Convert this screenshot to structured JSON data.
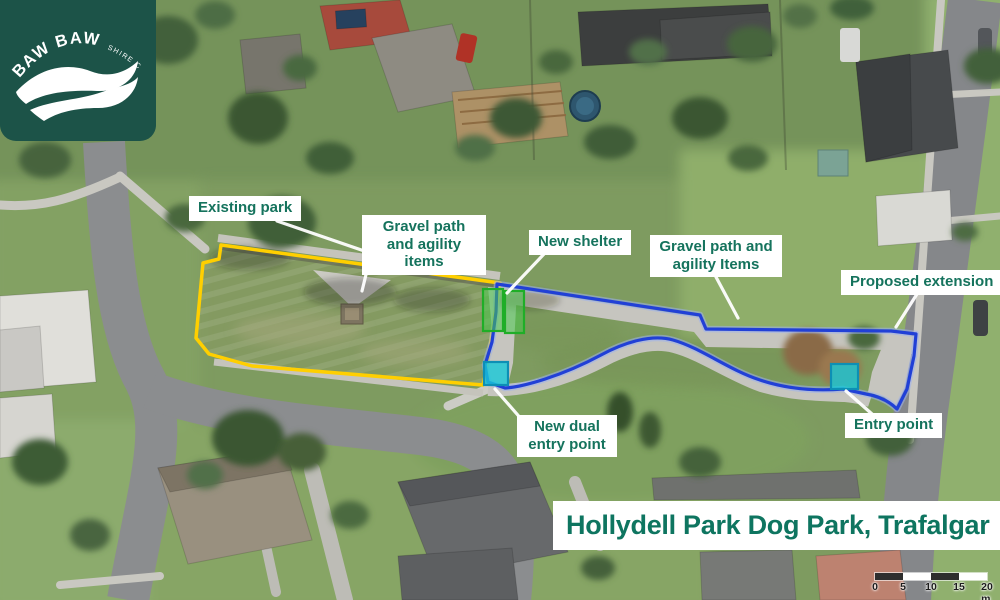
{
  "logo": {
    "org_arc_primary": "BAW BAW",
    "org_arc_secondary": "SHIRE COUNCIL"
  },
  "map": {
    "title": "Hollydell Park Dog Park, Trafalgar",
    "annotations": {
      "existing_park": "Existing park",
      "gravel_path_existing": "Gravel path and agility items",
      "new_shelter": "New shelter",
      "gravel_path_extension": "Gravel path and agility Items",
      "proposed_extension": "Proposed extension",
      "new_dual_entry_point": "New dual entry point",
      "entry_point": "Entry point"
    },
    "colors": {
      "existing_park_outline": "#ffcf00",
      "proposed_extension_outline": "#2140d6",
      "new_shelter_fill": "#49c84d",
      "new_shelter_stroke": "#1fae27",
      "entry_point_fill": "#17c8d8",
      "entry_point_stroke": "#0d8fb5",
      "label_text": "#15735d",
      "title_text": "#0e7560",
      "logo_background": "#1c5348"
    },
    "scale_bar": {
      "ticks": [
        "0",
        "5",
        "10",
        "15",
        "20 m"
      ]
    }
  }
}
